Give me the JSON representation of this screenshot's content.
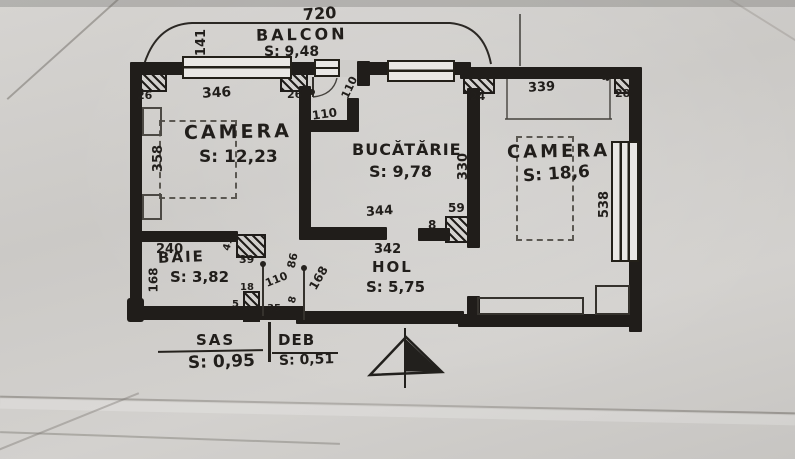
{
  "rooms": {
    "balcon": {
      "name": "BALCON",
      "area": "S: 9,48"
    },
    "camera1": {
      "name": "CAMERA",
      "area": "S: 12,23"
    },
    "bucatarie": {
      "name": "BUCĂTĂRIE",
      "area": "S: 9,78"
    },
    "camera2": {
      "name": "CAMERA",
      "area": "S: 18,6"
    },
    "baie": {
      "name": "BAIE",
      "area": "S: 3,82"
    },
    "hol": {
      "name": "HOL",
      "area": "S: 5,75"
    },
    "sas": {
      "name": "SAS",
      "area": "S: 0,95"
    },
    "deb": {
      "name": "DEB",
      "area": "S: 0,51"
    }
  },
  "dimensions": {
    "total_width": "720",
    "balcony_depth": "141",
    "balcony_window": "346",
    "pier_left": "26",
    "pier_mid": "26",
    "balcony_door": "110",
    "kitchen_entry": "110",
    "pier_right": "24",
    "camera2_top": "339",
    "corner_pier_side": "8",
    "corner_pier": "28",
    "camera1_height": "358",
    "bucatarie_height": "330",
    "bucatarie_bottom": "344",
    "hol_top": "342",
    "right_window": "538",
    "pier59": "59",
    "pier59_side": "8",
    "baie_top": "240",
    "baie_door_side": "41",
    "baie_door_pier": "39",
    "baie_height": "168",
    "sas_height": "168",
    "sas_door": "110",
    "d86": "86",
    "d18": "18",
    "d5": "5",
    "d35": "35",
    "d8": "8"
  },
  "icons": {
    "north_arrow": "half-filled-triangle"
  },
  "colors": {
    "ink": "#211e1b",
    "pencil": "#4c4944",
    "paper": "#cfccca"
  }
}
